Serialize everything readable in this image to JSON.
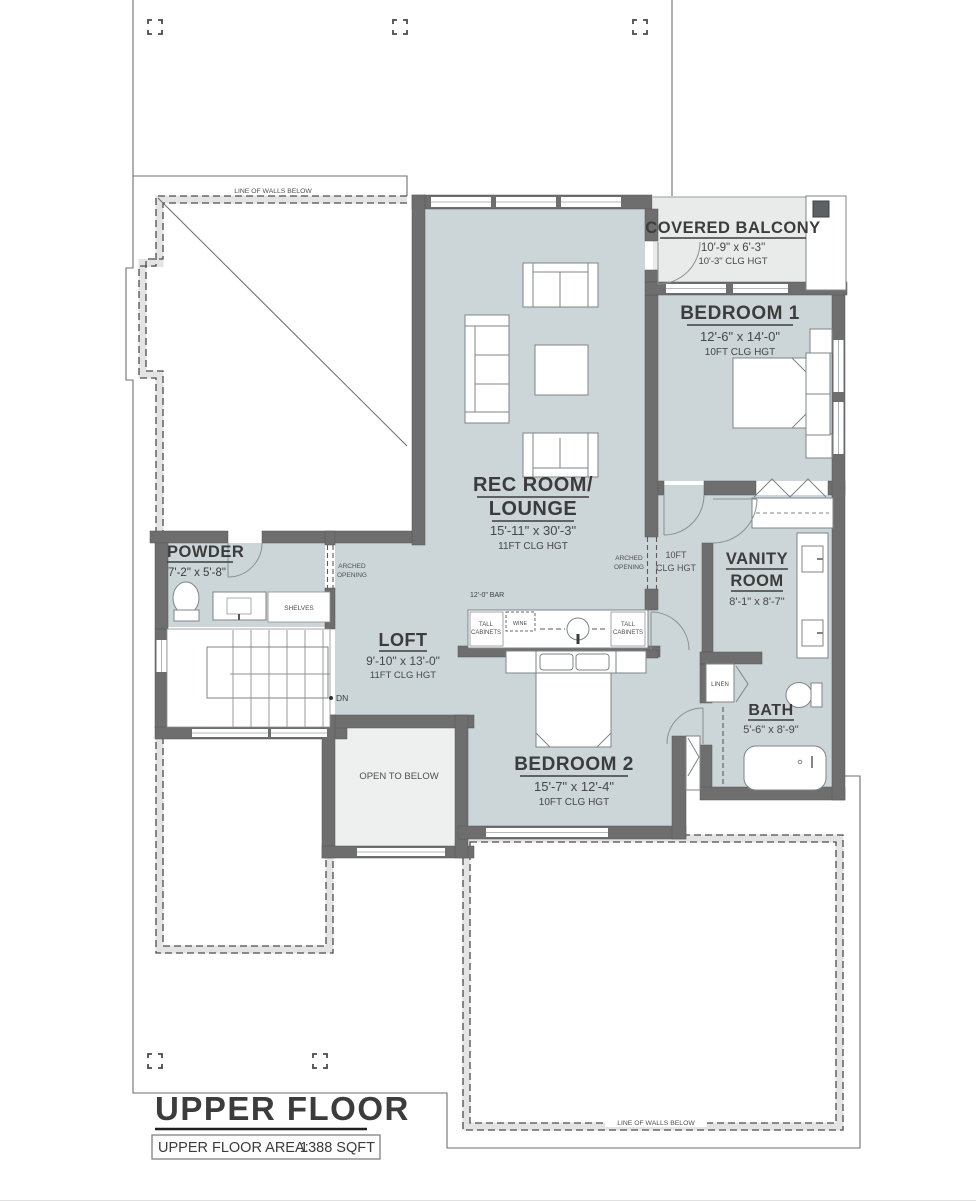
{
  "sheet": {
    "title": "UPPER FLOOR",
    "area_label": "UPPER FLOOR AREA:",
    "area_value": "1388 SQFT",
    "walls_below_top": "LINE OF WALLS BELOW",
    "walls_below_bottom": "LINE OF WALLS BELOW"
  },
  "rooms": {
    "covered_balcony": {
      "name": "COVERED BALCONY",
      "dims": "10'-9\" x 6'-3\"",
      "ceiling": "10'-3\" CLG HGT"
    },
    "bedroom1": {
      "name": "BEDROOM 1",
      "dims": "12'-6\" x 14'-0\"",
      "ceiling": "10FT CLG HGT"
    },
    "rec_room": {
      "name_line1": "REC ROOM/",
      "name_line2": "LOUNGE",
      "dims": "15'-11\" x 30'-3\"",
      "ceiling": "11FT CLG HGT"
    },
    "powder": {
      "name": "POWDER",
      "dims": "7'-2\" x 5'-8\""
    },
    "vanity": {
      "name_line1": "VANITY",
      "name_line2": "ROOM",
      "dims": "8'-1\" x 8'-7\""
    },
    "loft": {
      "name": "LOFT",
      "dims": "9'-10\" x 13'-0\"",
      "ceiling": "11FT CLG HGT"
    },
    "bath": {
      "name": "BATH",
      "dims": "5'-6\" x 8'-9\""
    },
    "bedroom2": {
      "name": "BEDROOM 2",
      "dims": "15'-7\" x 12'-4\"",
      "ceiling": "10FT CLG HGT"
    },
    "open_to_below": {
      "name": "OPEN TO BELOW"
    },
    "hall": {
      "ceiling_line1": "10FT",
      "ceiling_line2": "CLG HGT"
    }
  },
  "annotations": {
    "arched_line1": "ARCHED",
    "arched_line2": "OPENING",
    "bar": "12'-0\" BAR",
    "tall_line1": "TALL",
    "tall_line2": "CABINETS",
    "wine": "WINE",
    "shelves": "SHELVES",
    "linen": "LINEN",
    "down": "DN"
  },
  "colors": {
    "wall": "#6e6e6e",
    "room": "#ccd5d8",
    "balcony": "#e9eaea",
    "open_below": "#eef0f0",
    "ink": "#3c3c3c"
  }
}
